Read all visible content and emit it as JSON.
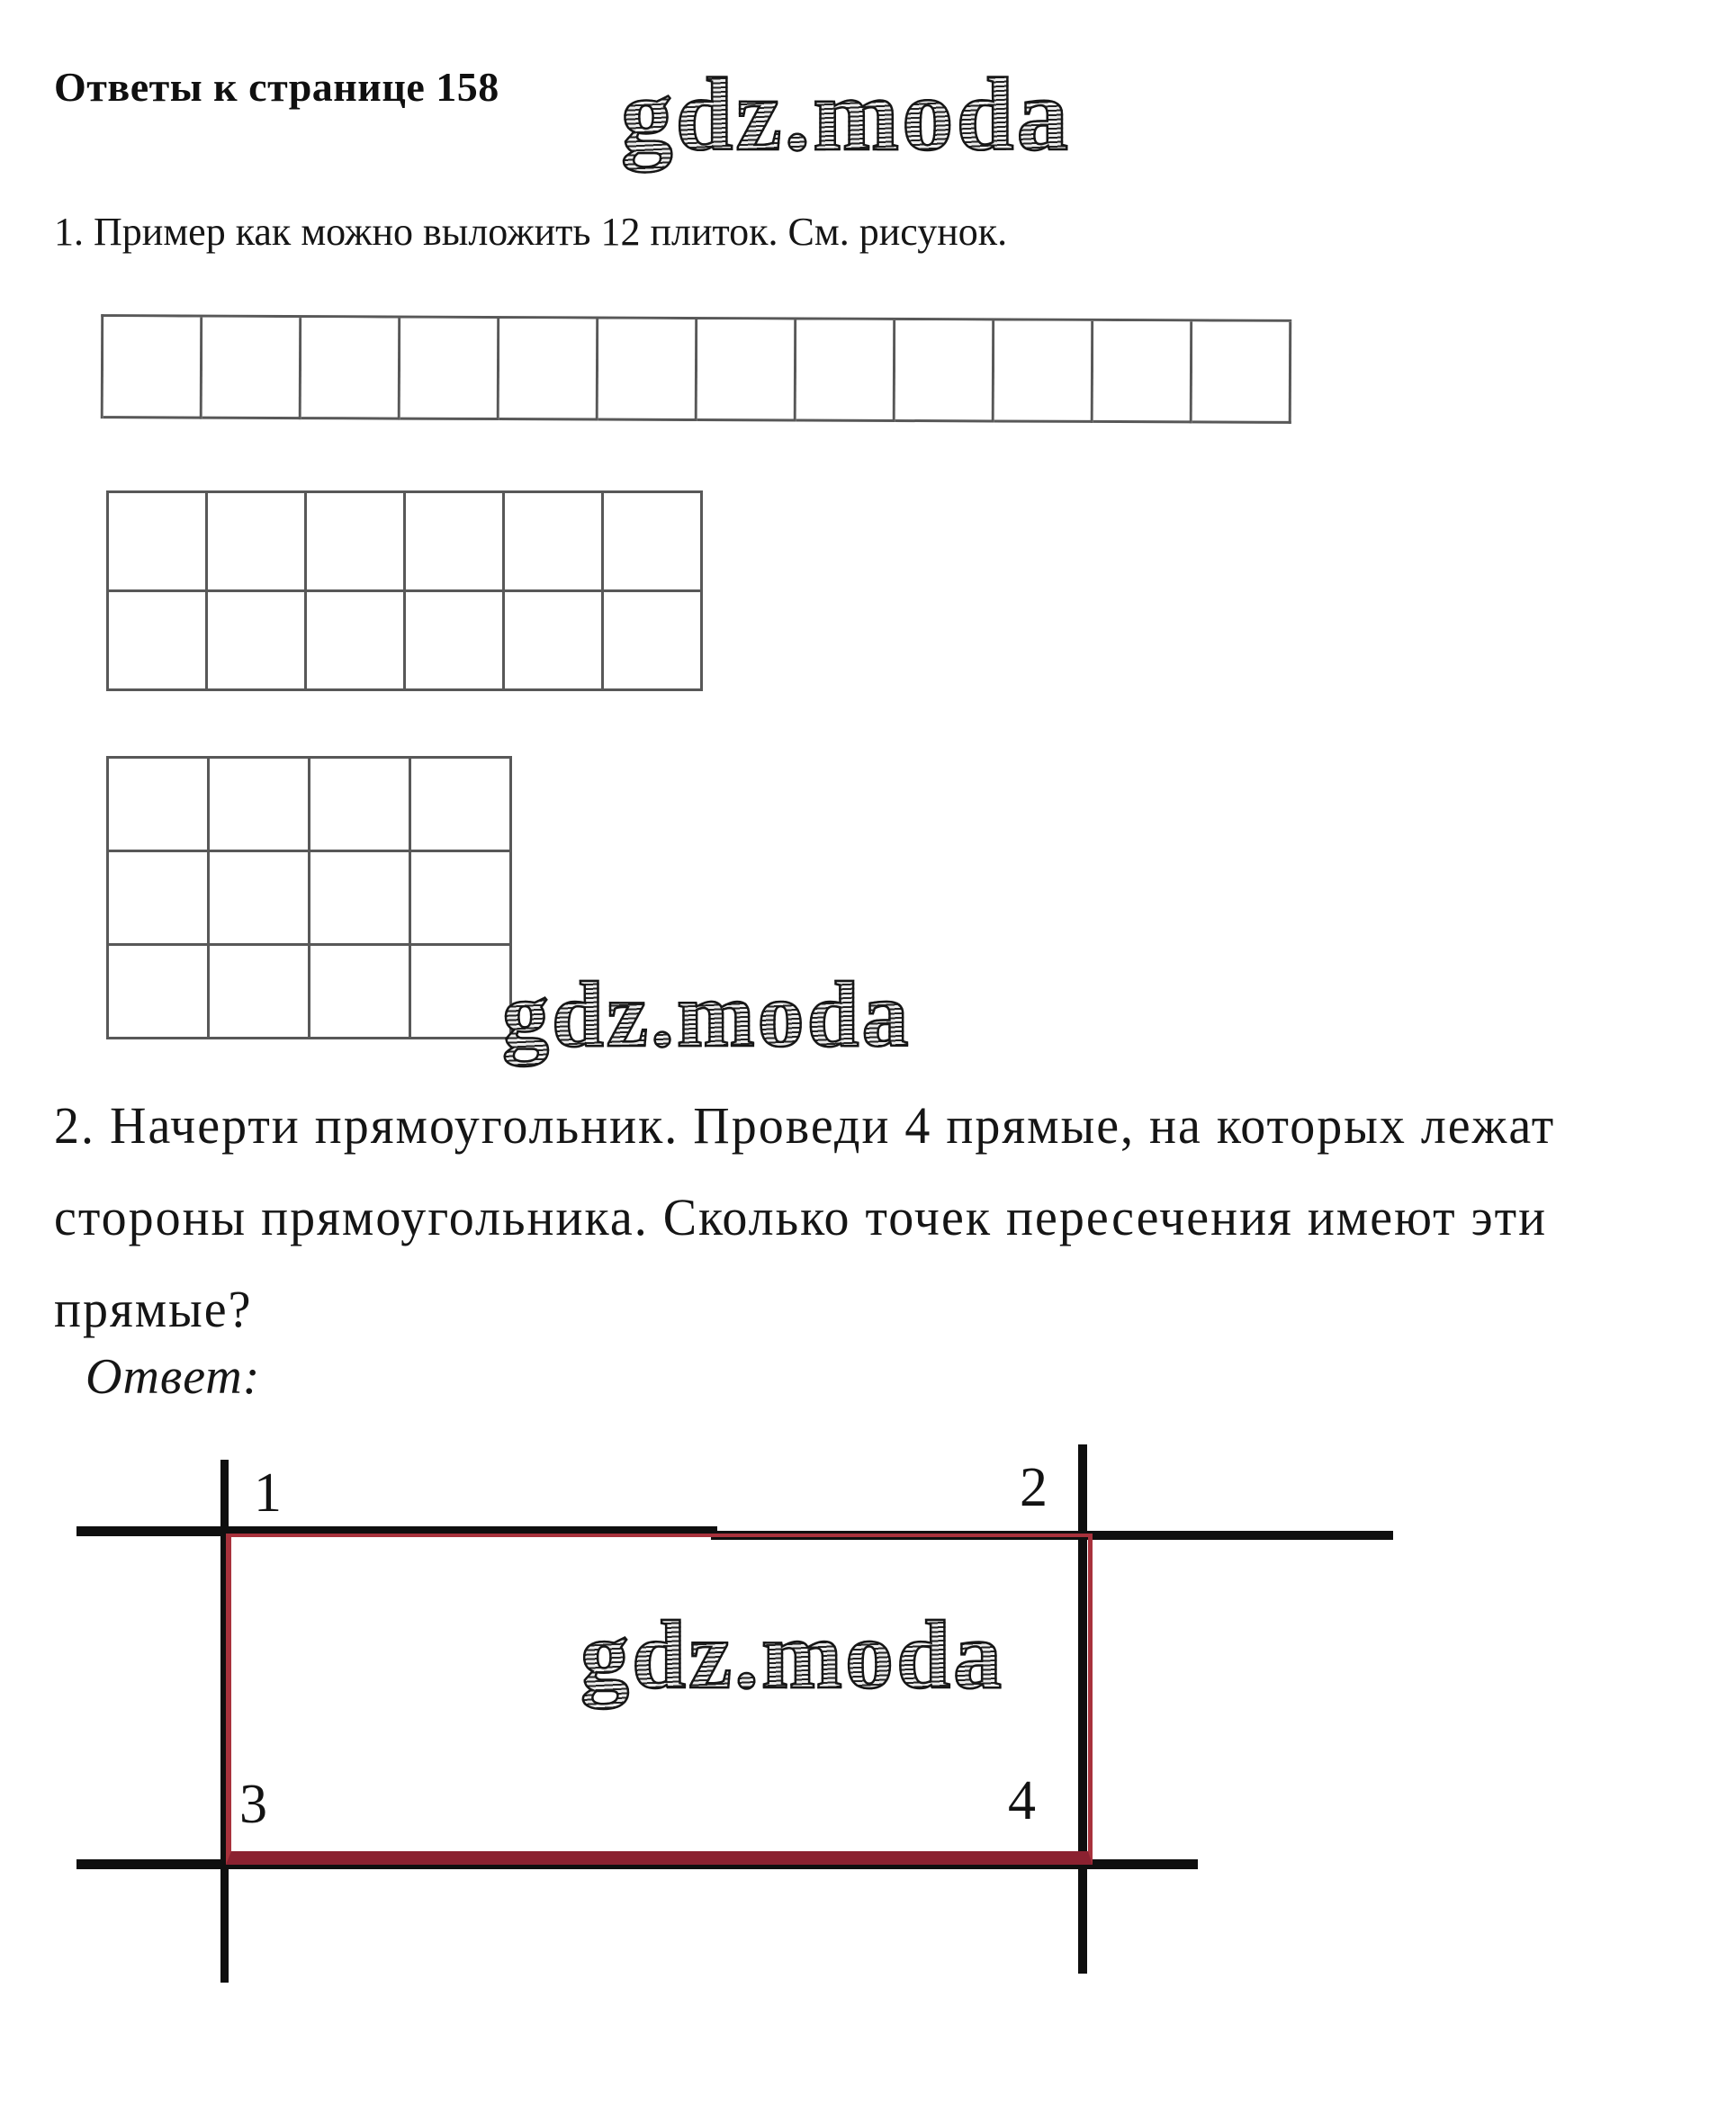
{
  "header": {
    "title": "Ответы к странице 158"
  },
  "watermark": {
    "text": "gdz.moda"
  },
  "task1": {
    "text": "1. Пример как можно выложить 12 плиток. См. рисунок.",
    "tile_count": 12,
    "grids": [
      {
        "label": "1x12",
        "rows": 1,
        "cols": 12
      },
      {
        "label": "2x6",
        "rows": 2,
        "cols": 6
      },
      {
        "label": "3x4",
        "rows": 3,
        "cols": 4
      }
    ]
  },
  "task2": {
    "lines": [
      "2. Начерти прямоугольник. Проведи 4 прямые, на которых лежат",
      "стороны прямоугольника. Сколько точек пересечения имеют эти",
      "прямые?"
    ],
    "answer_label": "Ответ:",
    "figure": {
      "labels": [
        "1",
        "2",
        "3",
        "4"
      ],
      "rectangle_color": "#a8323c",
      "rectangle_bottom_color": "#8b2130",
      "line_color": "#0f0f0f"
    }
  }
}
